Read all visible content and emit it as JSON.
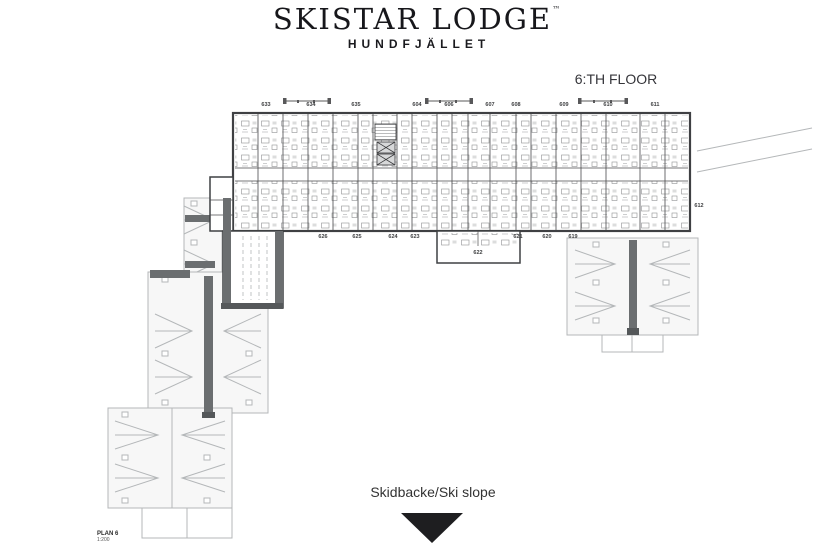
{
  "header": {
    "title": "SKISTAR LODGE",
    "trademark": "™",
    "subtitle": "HUNDFJÄLLET"
  },
  "floor_plan": {
    "floor_label": "6:TH FLOOR",
    "rooms_top": [
      "633",
      "634",
      "635",
      "604",
      "606",
      "607",
      "608",
      "609",
      "610",
      "611"
    ],
    "rooms_bottom": [
      "626",
      "625",
      "624",
      "623",
      "622",
      "621",
      "620",
      "619"
    ],
    "room_right": "612",
    "sheet_label": "PLAN 6",
    "sheet_scale": "1:200"
  },
  "footer": {
    "slope_label": "Skidbacke/Ski slope"
  },
  "icons": {
    "slope_arrow": "down-triangle-icon"
  },
  "colors": {
    "ink": "#17171b",
    "wall": "#3f4043",
    "roof_line": "#b4b7b9",
    "corridor_fill": "#6b6e70",
    "corridor_dark": "#55585a",
    "triangle": "#1e1e20"
  }
}
